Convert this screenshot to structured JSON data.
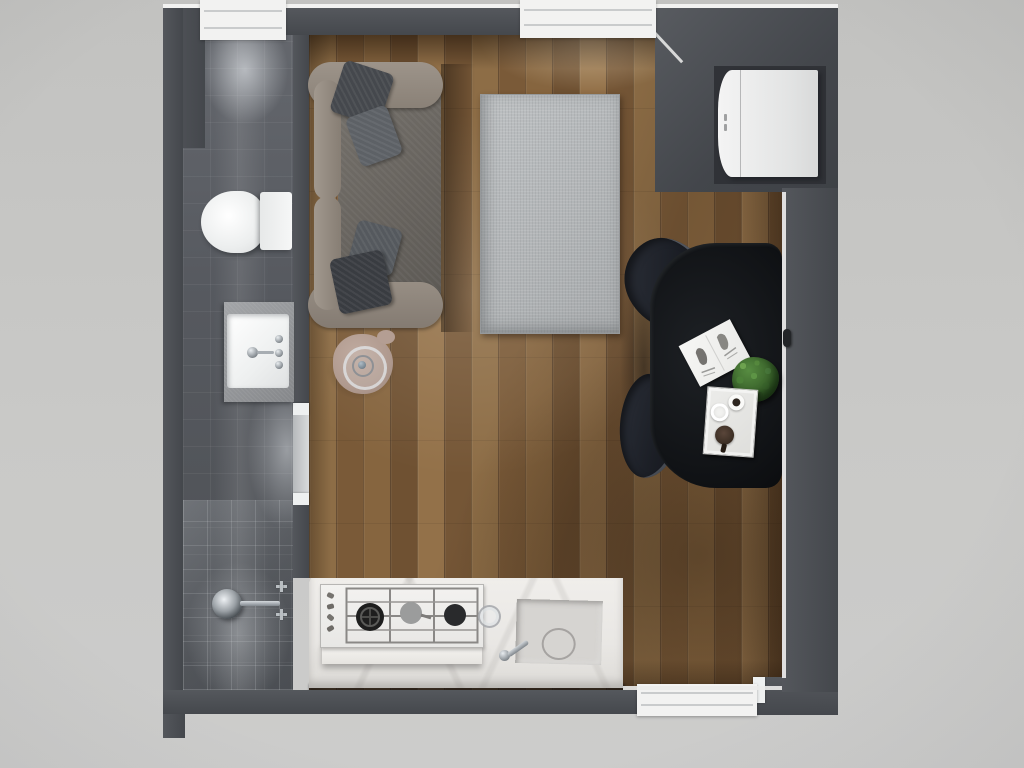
{
  "scene": {
    "title": "Top-down 3D render of a studio apartment floor plan",
    "view": "top-down 3D render",
    "canvas_px": "1024x768"
  },
  "palette": {
    "outer_background": "#c7c6c4",
    "wall": "#4a4d52",
    "wall_highlight": "#f0f0ef",
    "wood_floor": "#7f5f3c",
    "bathroom_tile": "#595c62",
    "marble_counter": "#edebe8",
    "sofa_fabric": "#94897f",
    "sofa_seat": "#6e6a64",
    "cushion_dark": "#3a3d42",
    "rug": "#b5b8ba",
    "dining_table": "#121417",
    "chair": "#23262e",
    "plant": "#3e662f",
    "side_table": "#b29c91",
    "fixture_white": "#f3f4f4",
    "chrome": "#9aa0a5"
  },
  "rooms": {
    "bathroom": {
      "label": "Bathroom with dark tile floor",
      "doorway": {
        "label": "Open doorway between bathroom and living area"
      },
      "fixtures": {
        "toilet": {
          "label": "White toilet with tank"
        },
        "vanity": {
          "label": "Vanity with white basin and chrome faucet"
        },
        "shower": {
          "label": "Walk-in shower with round rain head and two wall handles"
        }
      }
    },
    "main_room": {
      "label": "Open-plan living room and kitchen with wood plank floor",
      "furniture": {
        "sofa": {
          "label": "Gray fabric sofa with rolled arms and four scatter cushions",
          "cushions": 4
        },
        "rug": {
          "label": "Light gray woven area rug"
        },
        "side_table": {
          "label": "Round beige side table with glass tray"
        },
        "dining_table": {
          "label": "Black dining table against right wall"
        },
        "chairs": {
          "label": "Dark upholstered dining chairs",
          "count": 2
        },
        "book": {
          "label": "Open white magazine on table"
        },
        "plant": {
          "label": "Small green shrub plant on table"
        },
        "tray": {
          "label": "White serving tray",
          "items": [
            "espresso cup",
            "small bowl",
            "muffin"
          ]
        },
        "fridge": {
          "label": "White refrigerator in wall niche",
          "doors": 2
        },
        "island": {
          "label": "Kitchen island with white marble worktop",
          "stove": {
            "label": "Built-in gas hob",
            "burners": 3,
            "knobs": 4
          },
          "sink": {
            "label": "Marble kitchen sink with chrome mixer tap"
          },
          "glass": {
            "label": "Drinking glass on worktop"
          }
        }
      }
    }
  },
  "openings": {
    "window_top_left": {
      "label": "Window in top wall above bathroom"
    },
    "window_top_middle": {
      "label": "Window in top wall above living area"
    },
    "window_bottom": {
      "label": "Window in bottom wall near kitchen"
    }
  },
  "details": {
    "wall_handle": {
      "label": "Handle on right wall"
    }
  }
}
